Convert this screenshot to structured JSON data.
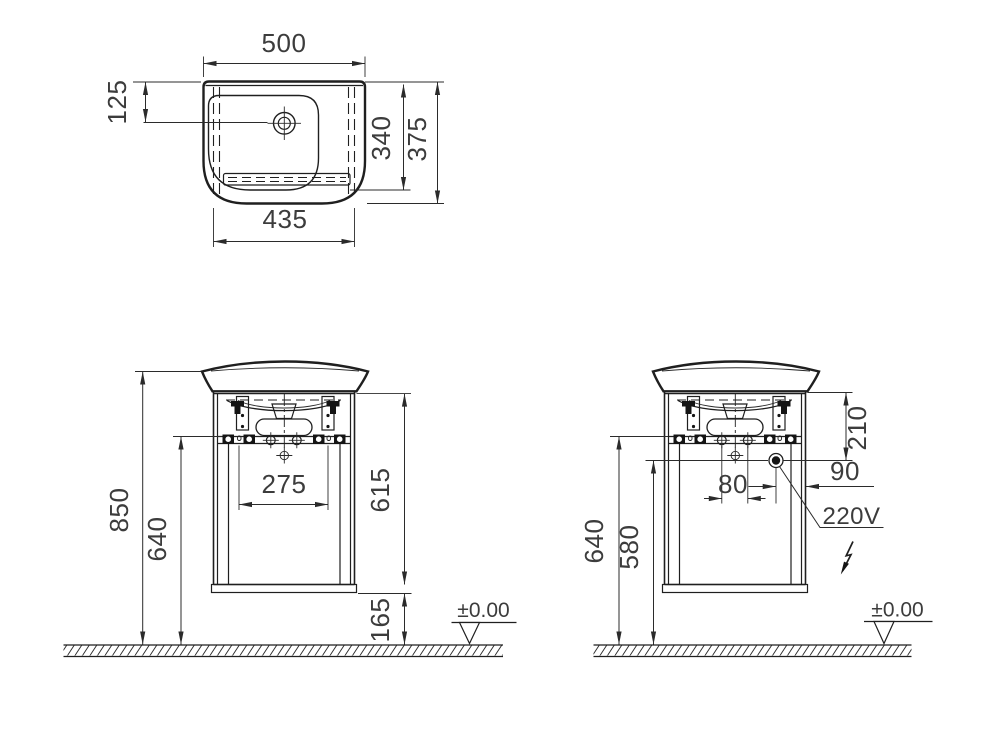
{
  "views": {
    "plan": {
      "dims": {
        "overall_width": "500",
        "tap_hole_offset": "125",
        "inner_depth": "340",
        "overall_depth": "375",
        "inner_width": "435"
      }
    },
    "front": {
      "dims": {
        "total_height": "850",
        "mounting_height": "640",
        "fixing_hole_span": "275",
        "cabinet_height": "615",
        "floor_clearance": "165"
      },
      "ground_label": "±0.00"
    },
    "side": {
      "dims": {
        "mounting_height": "640",
        "socket_height": "580",
        "top_to_socket": "210",
        "fixing_hole_span": "80",
        "socket_to_edge": "90"
      },
      "socket_label": "220V",
      "ground_label": "±0.00"
    }
  }
}
